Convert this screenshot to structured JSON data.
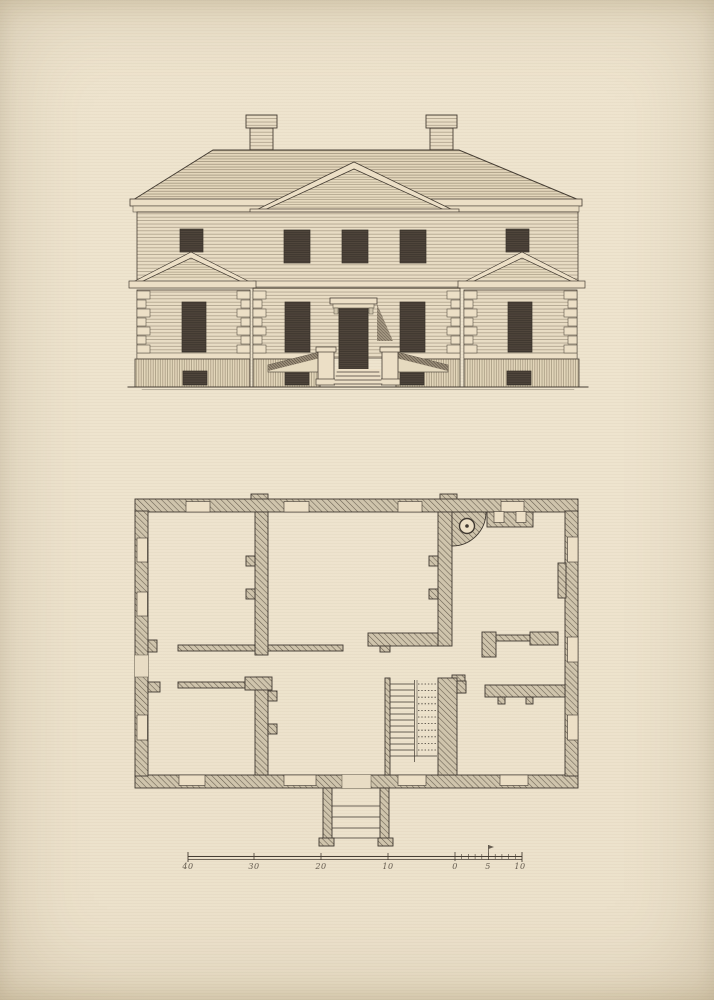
{
  "scale_bar": {
    "labels": [
      "40",
      "30",
      "20",
      "10",
      "0",
      "5",
      "10"
    ],
    "units_major_interval": 10,
    "subdivided_segment_ticks": 10
  },
  "colors": {
    "paper": "#e8dcc4",
    "ink": "#463e34",
    "fine_line": "#5d5447",
    "wall_hatch": "#675d4f",
    "window_dark": "#4c433a",
    "shadow": "#4e4337"
  }
}
